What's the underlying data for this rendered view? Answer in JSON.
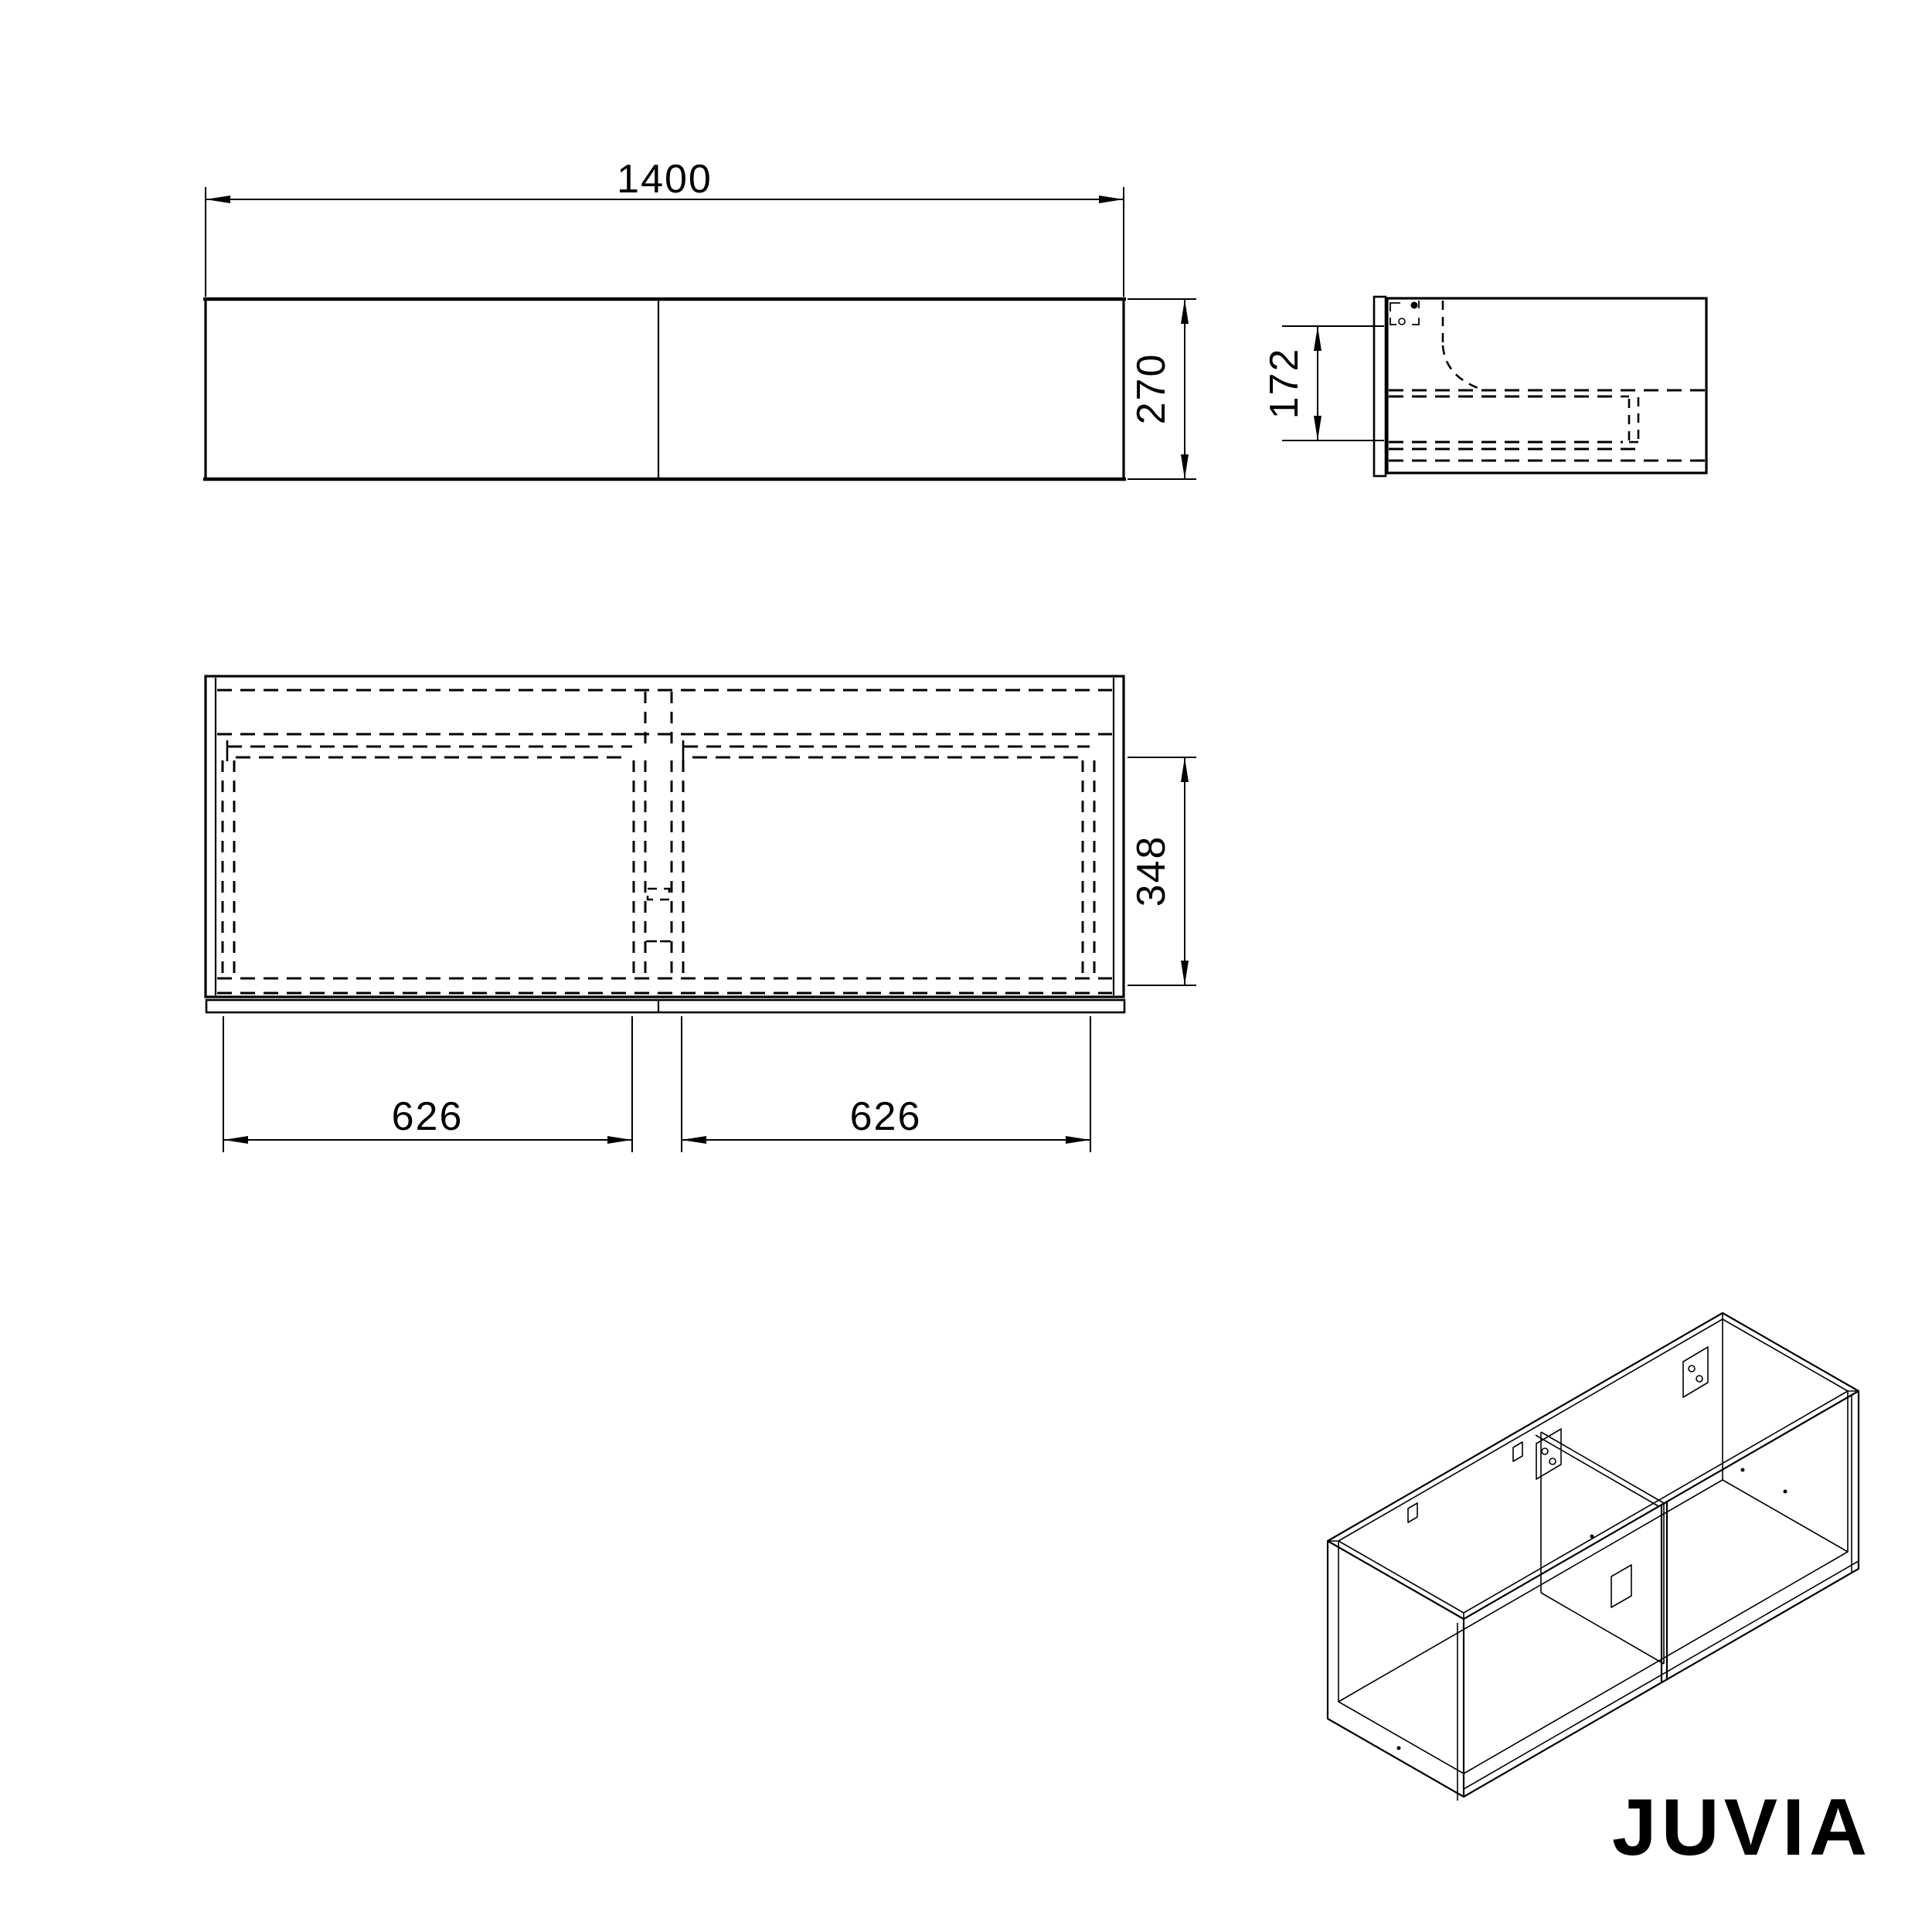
{
  "drawing": {
    "brand": "JUVIA",
    "dims": {
      "front_width": "1400",
      "front_height": "270",
      "side_mount": "172",
      "plan_depth": "348",
      "drawer_left": "626",
      "drawer_right": "626"
    }
  }
}
